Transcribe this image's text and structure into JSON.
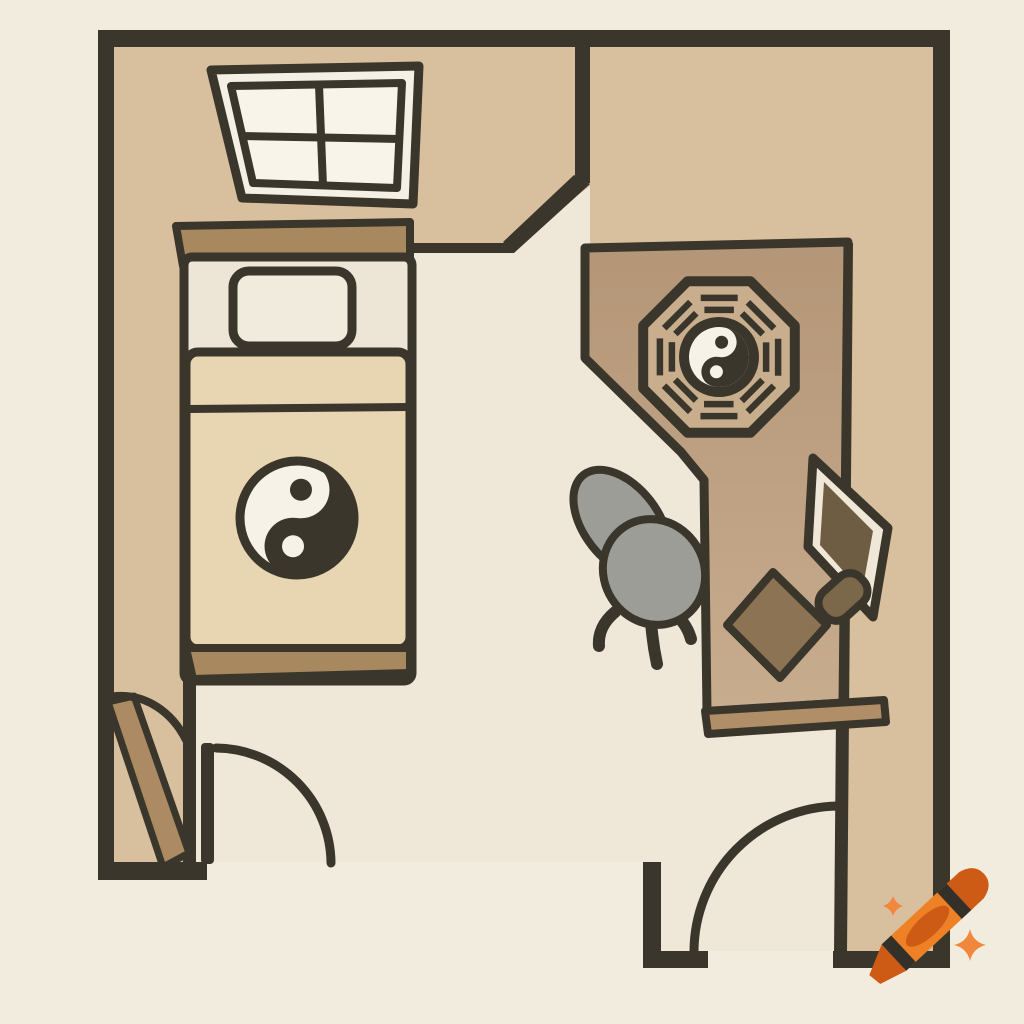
{
  "scene": {
    "kind": "floor-plan-illustration",
    "subject": "feng-shui bedroom and office floor plan, top-down cartoon style",
    "rooms": [
      "bedroom-alcove-with-window",
      "main-floor",
      "desk-area",
      "entry-corridor"
    ],
    "furniture": [
      "single-bed-with-yin-yang-blanket",
      "pillow",
      "headboard",
      "footboard",
      "bagua-octagon-with-yin-yang",
      "office-chair",
      "desk",
      "monitor",
      "mouse",
      "desk-pad-diamond",
      "window-4-pane",
      "door-left",
      "door-middle",
      "door-right"
    ],
    "watermark": "orange crayon with two sparkles (AI generator logo)"
  },
  "colors": {
    "ink": "#3a362b",
    "bgOutside": "#f2ecde",
    "floorTan": "#d8c09e",
    "floorCream": "#efe8d8",
    "windowFrame": "#f5f0e4",
    "windowPane": "#f8f4ea",
    "bedSheet": "#ede6d6",
    "pillow": "#f1ebdd",
    "blanket": "#e8d6b2",
    "board": "#a8885f",
    "deskTop": "#b49677",
    "deskBottom": "#c8ac8e",
    "deskLip": "#b08e68",
    "baguaFill": "#c9ae8e",
    "chairGray": "#9c9d97",
    "screenOlive": "#6e5d42",
    "mouseOlive": "#7b684a",
    "padOlive": "#8c7354",
    "door": "#ab8a64",
    "white": "#f6f2e8",
    "crayonOrange": "#ee8126",
    "crayonDark": "#ce5b15",
    "crayonBand": "#33302a",
    "sparkle": "#f1873c"
  }
}
